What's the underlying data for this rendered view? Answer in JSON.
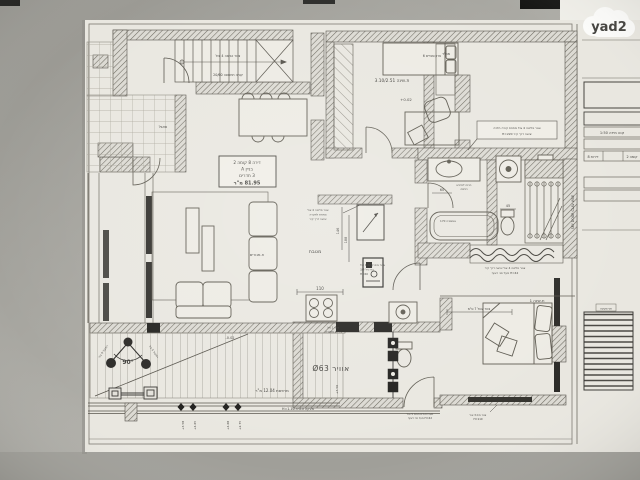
{
  "watermark": {
    "logo_text": "yad2"
  },
  "sheet": {
    "apartment_box": {
      "line1": "דירה 8 קומה 2",
      "line2": "בניין A",
      "line3": "3 חדרים",
      "line4": "81.95 מ\"ר"
    },
    "rooms": {
      "kitchen": "מטבח",
      "living": "ח.מגורים",
      "bedroom_top": "ת.שינה 3.10/2.51",
      "bedroom_top_level": "+0.02",
      "bedroom_bottom": "ת.שינה 1",
      "mamad": "ממ\"ד",
      "panel": "פאנל",
      "balcony": "מרפסת 12.04 מ\"ר",
      "air_duct": "אוויר Ø63",
      "tub": "אמבטיה 170"
    },
    "levels": {
      "l1": "+3.58",
      "l2": "+4.65",
      "l3": "+4.68",
      "l4": "+2.75",
      "wc": "+3.50",
      "balcony_level": "-0.02"
    },
    "dims": {
      "w110": "110",
      "h146": "146",
      "h188": "188",
      "d60": "60",
      "d45": "45"
    },
    "railing": "מעקה זכוכית H=1.10",
    "angle": "90°",
    "notes": {
      "stairs1": "צנור כביסה 4 צול",
      "stairs2": "קורה תחתונה 20/60",
      "bookshelf": "ארון ספרים 6",
      "kitchen1": "צנור פליטה 4 צול",
      "kitchen2": "מתחת לתקרה",
      "kitchen3": "יציאה דרך קיר",
      "valve1": "צנור מים קרים 1 צול",
      "valve2": "ברז ניל 3/4",
      "valve3": "H=60",
      "dryer1": "הכנה למייבש",
      "dryer2": "כביסה",
      "bath_bottom1": "צנור פליטה 4 צול יציאה דרך קיר",
      "bath_bottom2": "H=42 מעל פני ריצוף",
      "terrace1": "צנור פליטה 4 צול מתחת קורה תלויה",
      "terrace2": "יציאה דרך קיר H=220",
      "wc_top1": "צנור 1 צול",
      "wc_top2": "ירידה מתקרה",
      "bed_dim": "צנור עגול 7 ס\"מ",
      "bed1a": "צנור מים 3 צול",
      "bed1b": "H=110",
      "sys1": "מערכת מים חמים 5 צול",
      "sys2": "H=42 מעל פני ריצוף",
      "speaker_left": "רמקול 5 צול",
      "speaker_right": "רמקול 5 צול"
    },
    "title_block": {
      "company": "קבוצת גבסו",
      "company_sub": "יזמות ובנייה בע\"מ",
      "street_line": "ההסתדרות 17",
      "city": "חולון",
      "doc_type": "אינסטלציה",
      "scale": "קנה מידה 1:50",
      "cell_left": "דירות 8",
      "cell_right": "קומה 2",
      "note_bold1": "כל שינוי שיבוצע ע\"י הדייר",
      "note_bold2": "באחריות הדייר בלבד",
      "note_small1": "נא לבדוק את כל המידות",
      "note_small2": "באתר לפני תחילת ביצוע",
      "note_small3": "ולדווח למתכנן",
      "paragraph": [
        "הערות כלליות:",
        "1. כל המידות בס\"מ אלא אם צוין אחרת.",
        "2. יש לבדוק את כל המידות באתר.",
        "3. צנרת מים חמים/קרים 16 מ\"מ.",
        "4. קולטן ביוב ראשי 110 מ\"מ.",
        "5. גובה נקודות מים H=60 ס\"מ.",
        "6. כל שינוי באישור המתכנן בלבד.",
        "7. הביצוע בהתאם לתקן הישראלי.",
        "8. יש לאטום מעברי צנרת."
      ],
      "railing_label": "פני מעקה",
      "footer_project": "חולון קומה 2-דירה 8",
      "footer_type": "אינסטלציה",
      "side_text": "SKY DOOR CLAV WUE"
    }
  }
}
